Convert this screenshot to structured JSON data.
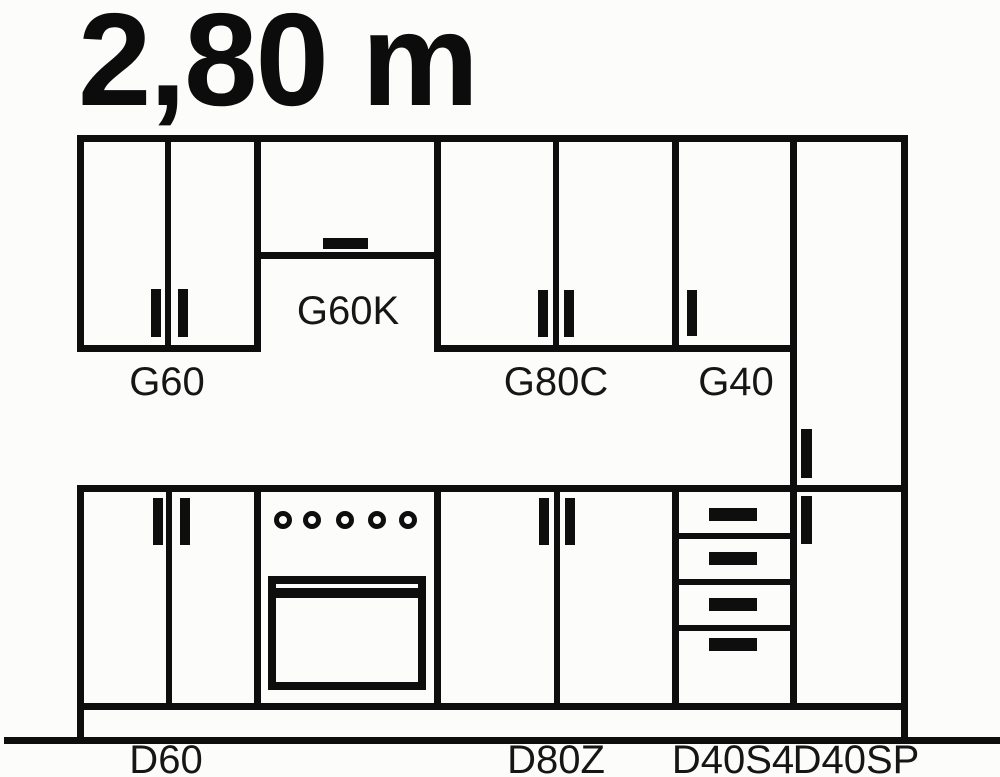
{
  "dimension_label": "2,80 m",
  "diagram": {
    "upper_row": {
      "cabinets": [
        {
          "code": "G60",
          "type": "wall cabinet, 2 doors",
          "doors": 2
        },
        {
          "code": "G60K",
          "type": "wall flap cabinet (short, horizontal handle)",
          "doors": 1
        },
        {
          "code": "G80C",
          "type": "wall cabinet, 2 doors",
          "doors": 2
        },
        {
          "code": "G40",
          "type": "wall cabinet, 1 door",
          "doors": 1
        }
      ]
    },
    "lower_row": {
      "cabinets": [
        {
          "code": "D60",
          "type": "base cabinet, 2 doors",
          "doors": 2
        },
        {
          "code": "",
          "type": "freestanding stove with oven",
          "knobs": 5
        },
        {
          "code": "D80Z",
          "type": "base cabinet, 2 doors",
          "doors": 2
        },
        {
          "code": "D40S4",
          "type": "base drawer unit",
          "drawers": 4
        },
        {
          "code": "D40SP",
          "type": "tall pantry cabinet, 2 doors",
          "doors": 2
        }
      ]
    },
    "colors": {
      "line": "#0e0e0e",
      "background": "#fcfcfa",
      "label": "#161616"
    }
  }
}
